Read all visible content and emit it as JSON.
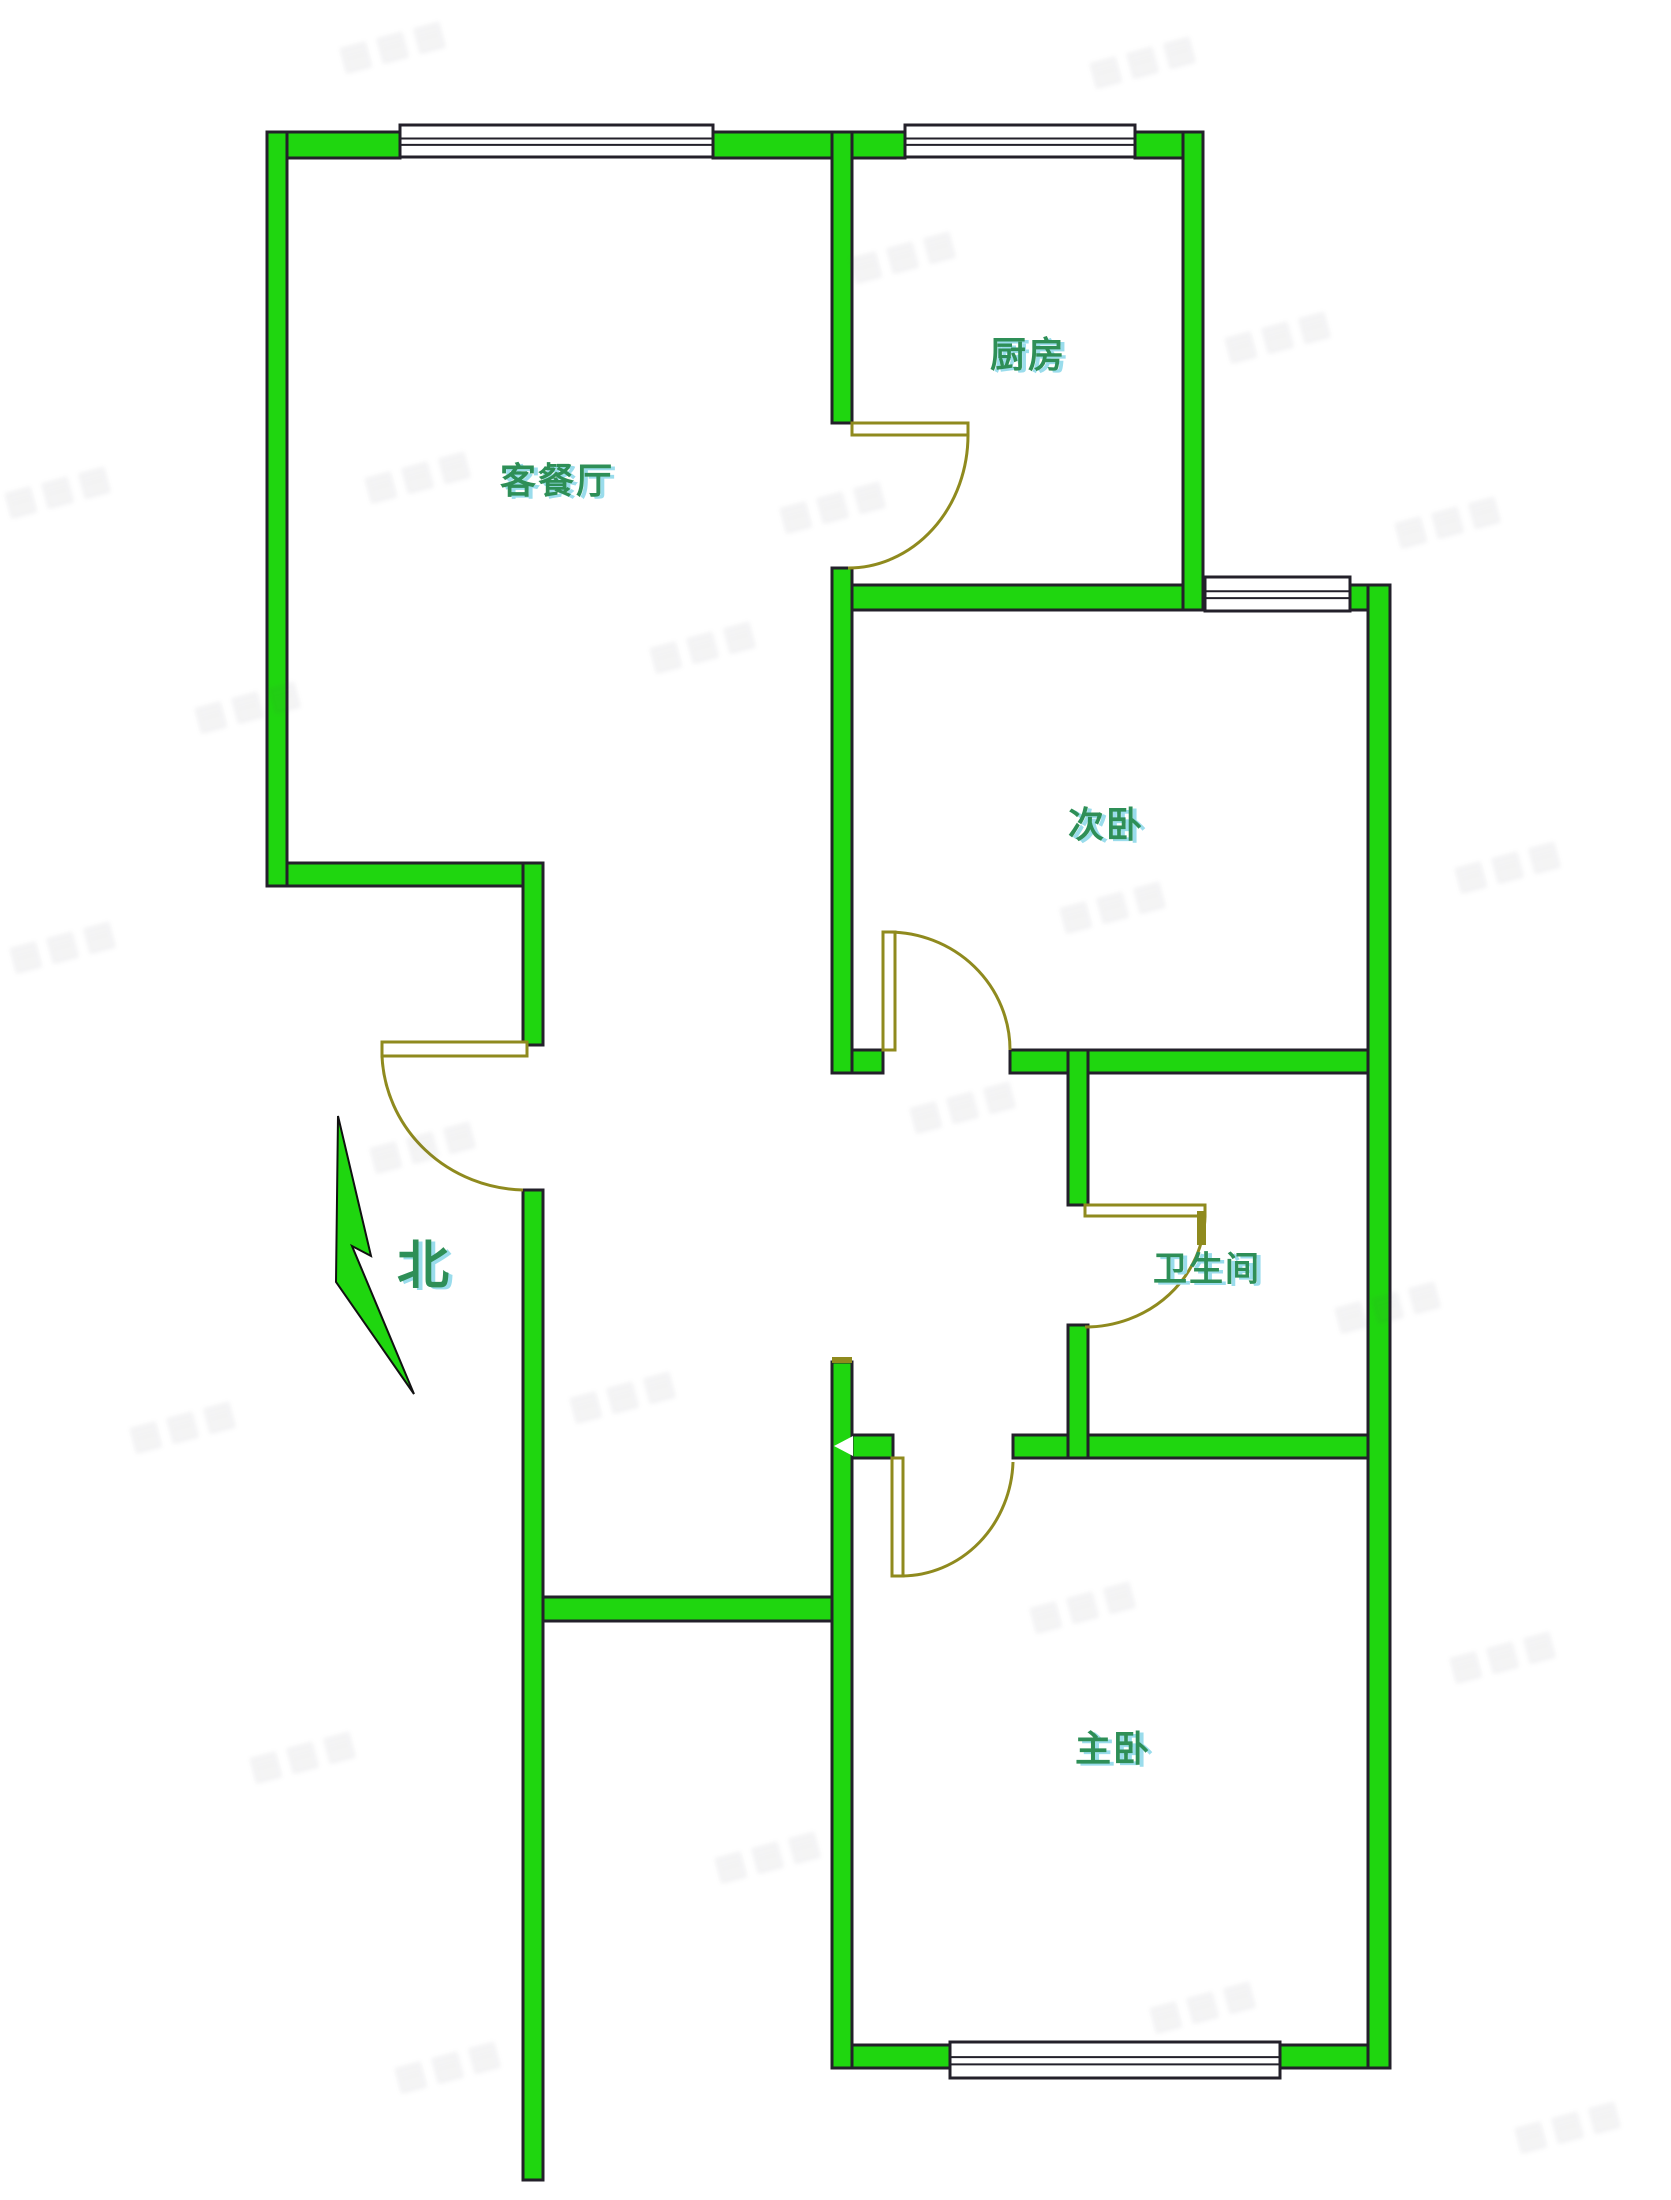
{
  "meta": {
    "type": "apartment-floor-plan",
    "canvas": {
      "width": 1671,
      "height": 2200
    }
  },
  "colors": {
    "background": "#ffffff",
    "wall_fill": "#1fd60f",
    "wall_outline": "#23202a",
    "door": "#8f8a1e",
    "window_fill": "#ffffff",
    "window_frame": "#23202a",
    "label_text": "#2e8f57",
    "label_shadow": "#9adcec",
    "watermark": "rgba(70,70,90,0.10)"
  },
  "rooms": [
    {
      "id": "living-dining",
      "label": "客餐厅",
      "cx": 557,
      "cy": 478,
      "size": 36
    },
    {
      "id": "kitchen",
      "label": "厨房",
      "cx": 1028,
      "cy": 352,
      "size": 36
    },
    {
      "id": "bedroom-second",
      "label": "次卧",
      "cx": 1106,
      "cy": 822,
      "size": 36
    },
    {
      "id": "bathroom",
      "label": "卫生间",
      "cx": 1207,
      "cy": 1266,
      "size": 34
    },
    {
      "id": "bedroom-master",
      "label": "主卧",
      "cx": 1113,
      "cy": 1746,
      "size": 36
    }
  ],
  "compass": {
    "label": "北",
    "cx": 423,
    "cy": 1261,
    "size": 52,
    "needle_points": "338,1116 371,1256 352,1246 414,1394 336,1282"
  },
  "walls": [
    [
      267,
      132,
      133,
      26
    ],
    [
      713,
      132,
      192,
      26
    ],
    [
      1135,
      132,
      68,
      26
    ],
    [
      852,
      585,
      353,
      25
    ],
    [
      1350,
      585,
      38,
      25
    ],
    [
      267,
      863,
      276,
      23
    ],
    [
      852,
      1050,
      31,
      23
    ],
    [
      1010,
      1050,
      362,
      23
    ],
    [
      852,
      1435,
      41,
      23
    ],
    [
      1013,
      1435,
      377,
      23
    ],
    [
      543,
      1597,
      309,
      24
    ],
    [
      833,
      2045,
      117,
      23
    ],
    [
      1280,
      2045,
      110,
      23
    ],
    [
      267,
      132,
      20,
      754
    ],
    [
      832,
      132,
      20,
      291
    ],
    [
      832,
      568,
      20,
      505
    ],
    [
      832,
      1362,
      20,
      706
    ],
    [
      1183,
      132,
      20,
      478
    ],
    [
      523,
      863,
      20,
      182
    ],
    [
      523,
      1190,
      20,
      990
    ],
    [
      1068,
      1050,
      20,
      155
    ],
    [
      1068,
      1325,
      20,
      133
    ],
    [
      1368,
      585,
      22,
      1483
    ]
  ],
  "windows": [
    [
      400,
      125,
      313,
      32
    ],
    [
      905,
      125,
      230,
      32
    ],
    [
      1205,
      577,
      145,
      34
    ],
    [
      950,
      2042,
      330,
      36
    ]
  ],
  "doors": [
    {
      "id": "kitchen-door",
      "leaf": [
        852,
        423,
        116,
        12
      ],
      "arc": "M968,435 A120,133 0 0 1 848,568"
    },
    {
      "id": "bedroom-second-door",
      "leaf": [
        883,
        932,
        12,
        118
      ],
      "arc": "M888,932 A122,118 0 0 1 1010,1050"
    },
    {
      "id": "bathroom-door",
      "leaf": [
        1085,
        1205,
        120,
        11
      ],
      "tick": [
        1197,
        1211,
        9,
        34
      ],
      "arc": "M1205,1216 A120,113 0 0 1 1085,1327"
    },
    {
      "id": "bedroom-master-door",
      "leaf": [
        892,
        1458,
        11,
        118
      ],
      "arc": "M902,1576 A112,118 0 0 0 1013,1462"
    },
    {
      "id": "entry-door",
      "leaf": [
        382,
        1042,
        145,
        14
      ],
      "arc": "M382,1056 A145,140 0 0 0 523,1190"
    }
  ],
  "artifacts": {
    "white_arrow_points": "834,1446 853,1436 853,1456",
    "olive_cap": [
      832,
      1357,
      20,
      6
    ]
  },
  "watermarks": {
    "glyphs": "▦▦▦",
    "positions": [
      [
        395,
        45
      ],
      [
        1145,
        60
      ],
      [
        905,
        255
      ],
      [
        1280,
        335
      ],
      [
        420,
        475
      ],
      [
        60,
        490
      ],
      [
        835,
        505
      ],
      [
        1450,
        520
      ],
      [
        250,
        705
      ],
      [
        705,
        645
      ],
      [
        1115,
        905
      ],
      [
        1510,
        865
      ],
      [
        65,
        945
      ],
      [
        425,
        1145
      ],
      [
        965,
        1105
      ],
      [
        1390,
        1305
      ],
      [
        185,
        1425
      ],
      [
        625,
        1395
      ],
      [
        1085,
        1605
      ],
      [
        1505,
        1655
      ],
      [
        305,
        1755
      ],
      [
        770,
        1855
      ],
      [
        1205,
        2005
      ],
      [
        450,
        2065
      ],
      [
        1570,
        2125
      ]
    ]
  }
}
